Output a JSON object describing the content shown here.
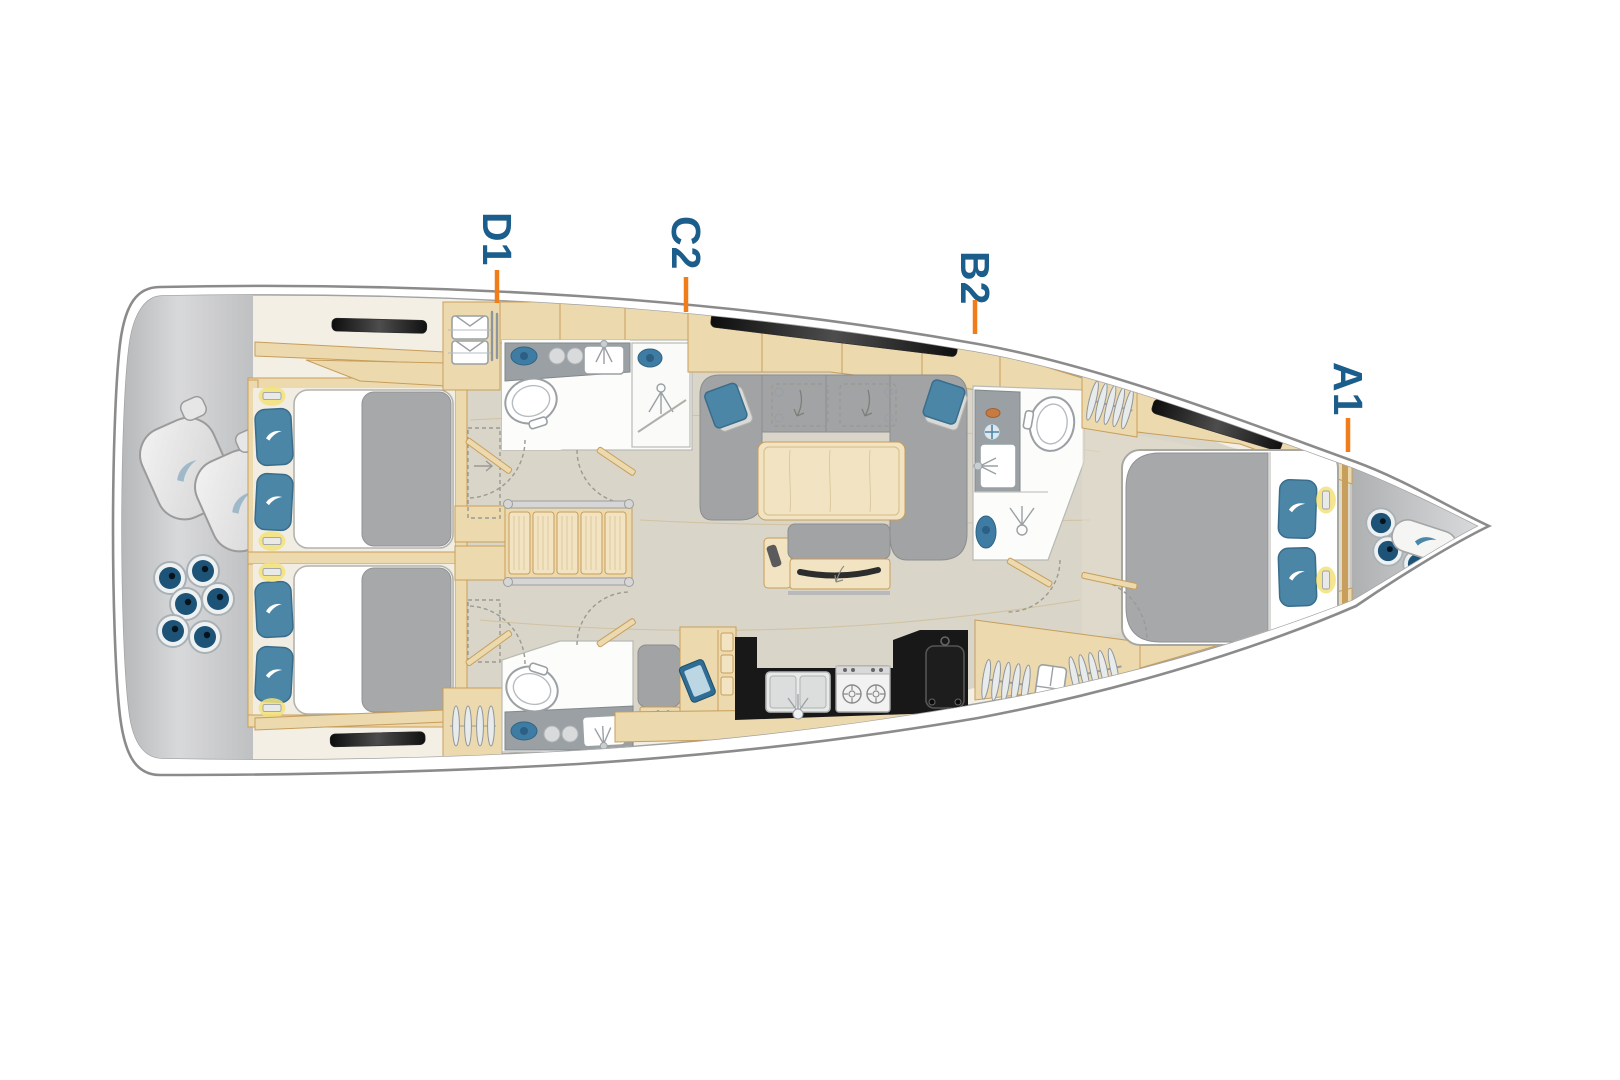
{
  "plan": {
    "title": "sailing-yacht-interior-deck-plan",
    "orientation": "bow-right",
    "cabin_markers": [
      {
        "label": "D1"
      },
      {
        "label": "C2"
      },
      {
        "label": "B2"
      },
      {
        "label": "A1"
      }
    ],
    "colors": {
      "marker_text": "#1c5e8b",
      "marker_tick": "#f07d1a",
      "hull_outline": "#8b8b8b",
      "deck_band": "#f4efe4",
      "floor": "#d9d5c9",
      "wood": "#ecd9ae",
      "upholstery": "#a2a3a5",
      "galley_counter": "#181818",
      "pillow_blue": "#4b86a6",
      "locker_gray": "#c3c4c6",
      "fender_blue": "#1d5377"
    },
    "regions": [
      {
        "name": "stern-storage"
      },
      {
        "name": "aft-cabin-port"
      },
      {
        "name": "aft-cabin-starboard"
      },
      {
        "name": "aft-head"
      },
      {
        "name": "companionway-stairs"
      },
      {
        "name": "saloon"
      },
      {
        "name": "galley"
      },
      {
        "name": "nav-station"
      },
      {
        "name": "head-d1"
      },
      {
        "name": "head-b2"
      },
      {
        "name": "owner-cabin"
      },
      {
        "name": "bow-sail-locker"
      }
    ]
  }
}
